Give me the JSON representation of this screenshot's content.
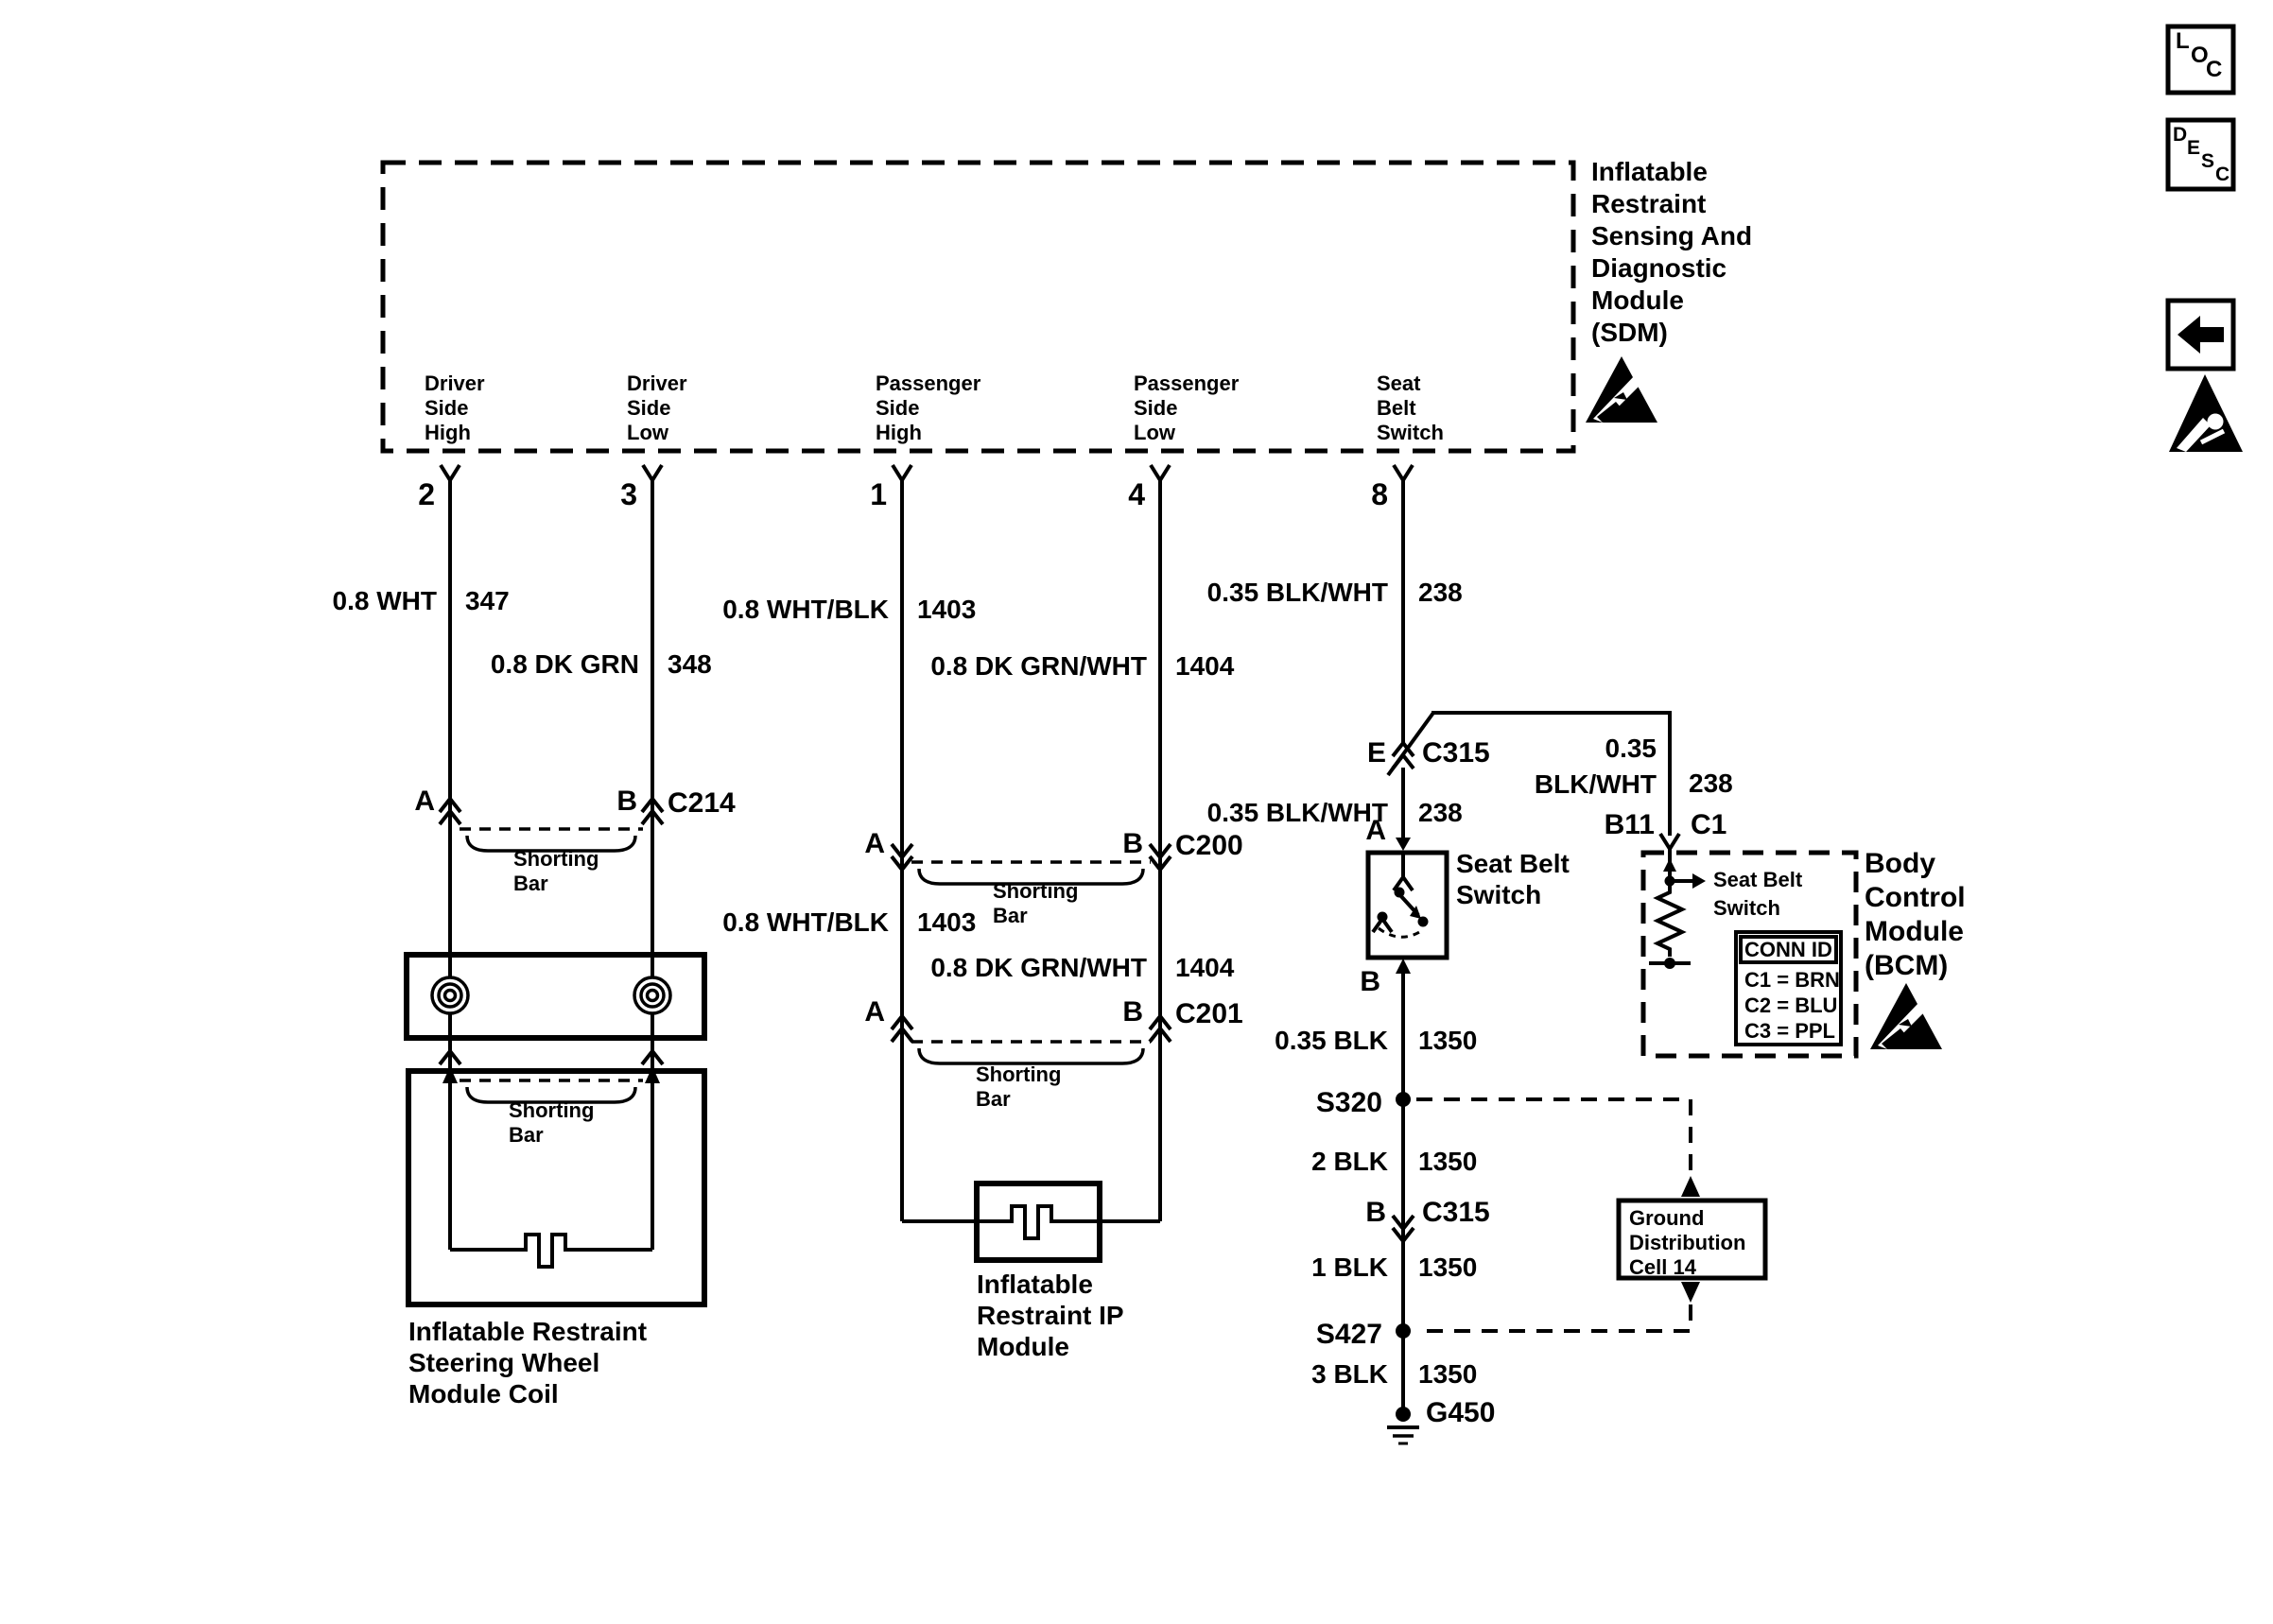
{
  "toolbar": {
    "loc": [
      "L",
      "O",
      "C"
    ],
    "desc": [
      "D",
      "E",
      "S",
      "C"
    ]
  },
  "sdm": {
    "title": "Inflatable\nRestraint\nSensing And\nDiagnostic\nModule\n(SDM)",
    "pins": [
      {
        "num": "2",
        "label": "Driver\nSide\nHigh"
      },
      {
        "num": "3",
        "label": "Driver\nSide\nLow"
      },
      {
        "num": "1",
        "label": "Passenger\nSide\nHigh"
      },
      {
        "num": "4",
        "label": "Passenger\nSide\nLow"
      },
      {
        "num": "8",
        "label": "Seat\nBelt\nSwitch"
      }
    ]
  },
  "rows": [
    {
      "name": "0.8 WHT",
      "circuit": "347"
    },
    {
      "name": "0.8 DK GRN",
      "circuit": "348"
    },
    {
      "name": "0.8 WHT/BLK",
      "circuit": "1403"
    },
    {
      "name": "0.8 DK GRN/WHT",
      "circuit": "1404"
    },
    {
      "name": "0.35 BLK/WHT",
      "circuit": "238"
    },
    {
      "name": "0.35 BLK/WHT",
      "circuit": "238"
    },
    {
      "name": "0.8 WHT/BLK",
      "circuit": "1403"
    },
    {
      "name": "0.8 DK GRN/WHT",
      "circuit": "1404"
    },
    {
      "name": "0.35\nBLK/WHT",
      "circuit": "238"
    },
    {
      "name": "0.35 BLK",
      "circuit": "1350"
    },
    {
      "name": "2 BLK",
      "circuit": "1350"
    },
    {
      "name": "1 BLK",
      "circuit": "1350"
    },
    {
      "name": "3 BLK",
      "circuit": "1350"
    }
  ],
  "conn": {
    "c214": {
      "a": "A",
      "b": "B",
      "id": "C214"
    },
    "c200": {
      "a": "A",
      "b": "B",
      "id": "C200"
    },
    "c201": {
      "a": "A",
      "b": "B",
      "id": "C201"
    },
    "c315_upper": {
      "pin": "E",
      "id": "C315"
    },
    "c315_lower": {
      "pin": "B",
      "id": "C315"
    },
    "bcm": {
      "pin": "B11",
      "id": "C1"
    },
    "switch_top": "A",
    "switch_bottom": "B"
  },
  "splices": {
    "s320": "S320",
    "s427": "S427",
    "ground": "G450"
  },
  "shorting_bar": "Shorting\nBar",
  "labels": {
    "steering_coil": "Inflatable Restraint\nSteering Wheel\nModule Coil",
    "ip_module": "Inflatable\nRestraint IP\nModule",
    "seat_belt_switch": "Seat Belt\nSwitch",
    "bcm": "Body\nControl\nModule\n(BCM)",
    "bcm_internal_switch": "Seat Belt\nSwitch",
    "ground_cell": "Ground\nDistribution\nCell 14"
  },
  "conn_id": {
    "header": "CONN ID",
    "rows": "C1 = BRN\nC2 = BLU\nC3 = PPL"
  }
}
